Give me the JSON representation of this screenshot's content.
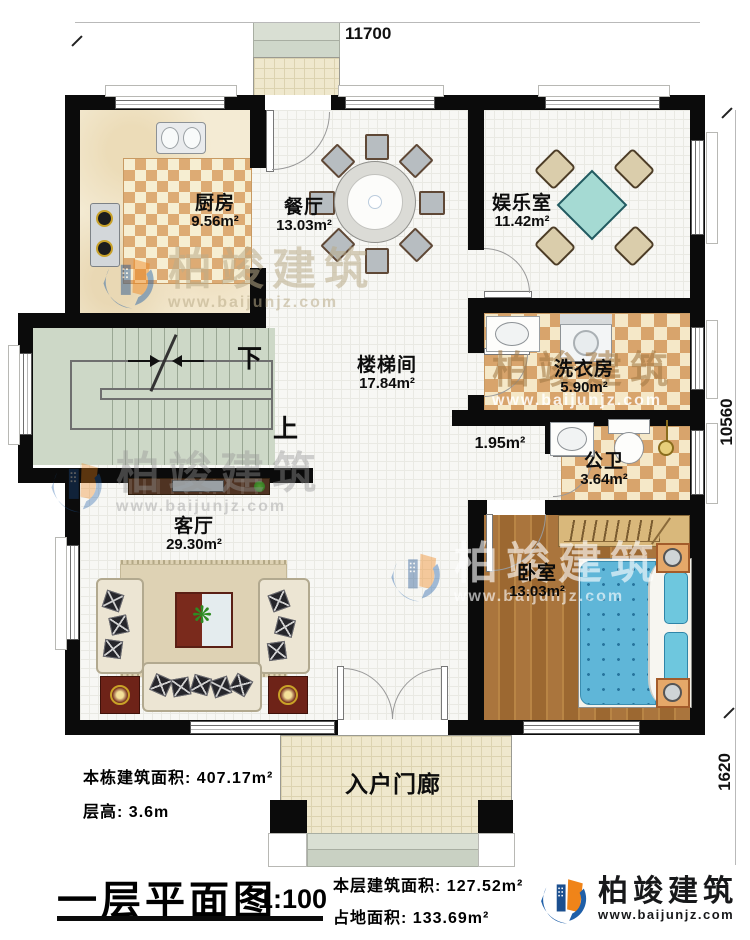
{
  "title": {
    "text": "一层平面图",
    "scale": "1:100"
  },
  "dimensions": {
    "width_top": "11700",
    "height_main": "10560",
    "height_porch": "1620"
  },
  "rooms": {
    "kitchen": {
      "name": "厨房",
      "area": "9.56m²"
    },
    "dining": {
      "name": "餐厅",
      "area": "13.03m²"
    },
    "entertainment": {
      "name": "娱乐室",
      "area": "11.42m²"
    },
    "stairwell": {
      "name": "楼梯间",
      "area": "17.84m²"
    },
    "laundry": {
      "name": "洗衣房",
      "area": "5.90m²"
    },
    "hallway": {
      "area": "1.95m²"
    },
    "bathroom": {
      "name": "公卫",
      "area": "3.64m²"
    },
    "living": {
      "name": "客厅",
      "area": "29.30m²"
    },
    "bedroom": {
      "name": "卧室",
      "area": "13.03m²"
    },
    "porch": {
      "name": "入户门廊"
    }
  },
  "stairs": {
    "down": "下",
    "up": "上"
  },
  "notes": {
    "building_area_label": "本栋建筑面积:",
    "building_area": "407.17m²",
    "floor_height_label": "层高:",
    "floor_height": "3.6m",
    "floor_area_label": "本层建筑面积:",
    "floor_area": "127.52m²",
    "footprint_label": "占地面积:",
    "footprint": "133.69m²"
  },
  "brand": {
    "name": "柏竣建筑",
    "website": "www.baijunjz.com"
  },
  "colors": {
    "accent_blue": "#1f5fa8",
    "accent_orange": "#f08419",
    "wall": "#0b0b0b",
    "checker_tan": "#ddab74",
    "stair_green": "#cdd8c7",
    "bed_blue": "#5fb6d8"
  }
}
